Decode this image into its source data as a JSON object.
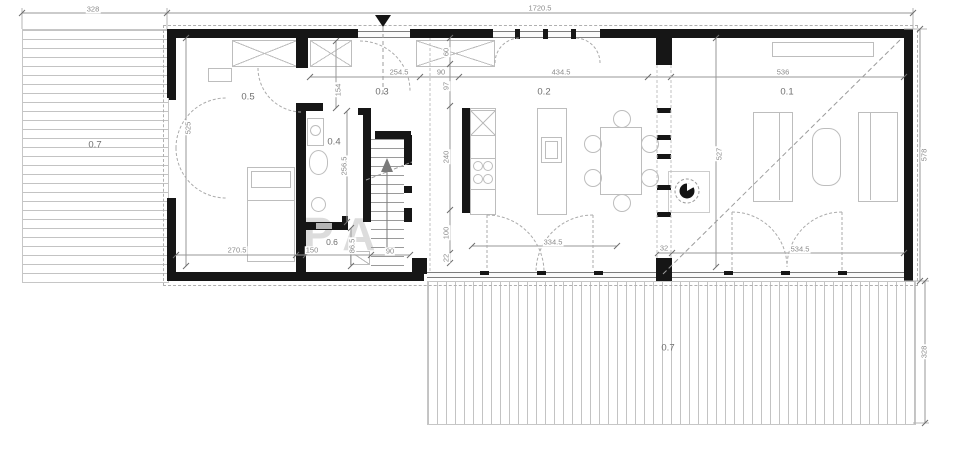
{
  "plan": {
    "watermark": "PA",
    "rooms": {
      "living": "0.1",
      "kitchen_dining": "0.2",
      "entry_hall": "0.3",
      "bathroom": "0.4",
      "bedroom": "0.5",
      "storage": "0.6",
      "deck_left": "0.7",
      "deck_bottom": "0.7"
    },
    "dims": {
      "deck_left_width": "328",
      "overall_width": "1720.5",
      "hall_width": "254.5",
      "passage_width": "90",
      "kitchen_width": "434.5",
      "living_width": "536",
      "wardrobe_depth": "60",
      "d97": "97",
      "kitchen_depth": "240",
      "d100": "100",
      "d22": "22",
      "hall_door": "154",
      "bedroom_depth": "525",
      "bath_depth": "256.5",
      "storage_depth": "86.5",
      "bedroom_width": "270.5",
      "storage_width": "150",
      "stair_width": "90",
      "kitchen_door_width": "334.5",
      "column_width": "32",
      "living_door_width": "534.5",
      "living_depth": "527",
      "overall_depth": "578",
      "deck_bottom_depth": "328"
    }
  }
}
